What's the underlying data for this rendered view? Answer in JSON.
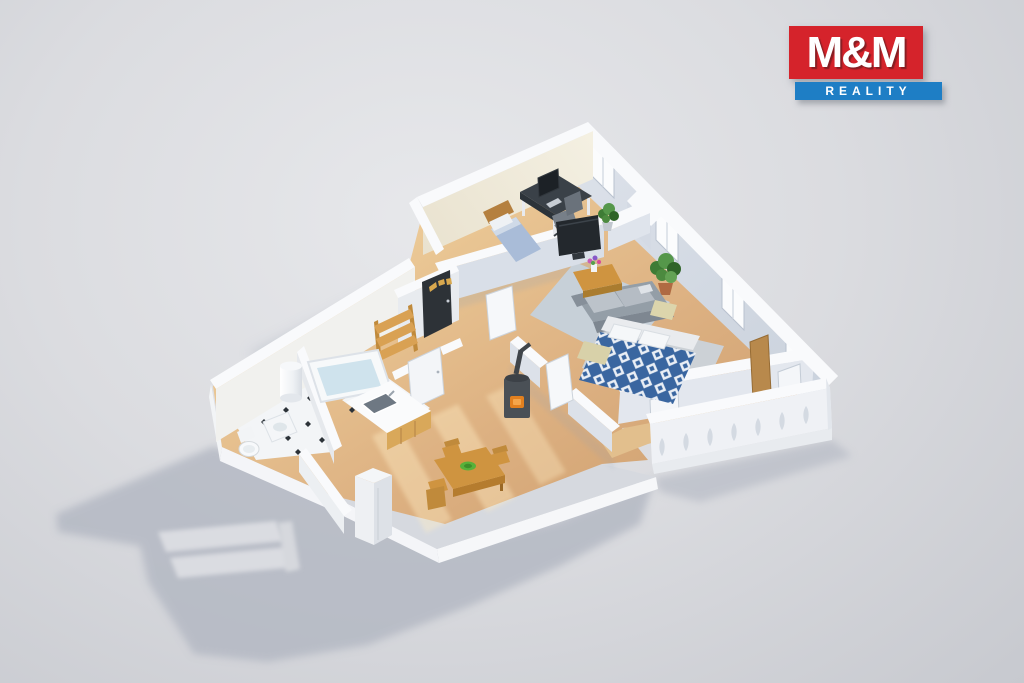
{
  "logo": {
    "title": "M&M",
    "subtitle": "REALITY"
  },
  "palette": {
    "bg_light": "#e7e8eb",
    "bg_mid": "#dbdce0",
    "bg_dark": "#c7c9cf",
    "shadow": "#b2b7c2",
    "wall_top": "#f9fafc",
    "wall_lit": "#f1eee2",
    "wall_shade": "#d5dbe5",
    "wood": "#ddb584",
    "wood_dark": "#c89a68",
    "tile": "#f3f5f7",
    "rug_living": "#c7d0d8",
    "rug_bed": "#ccd1d6",
    "bed_blue": "#3a66a0",
    "sofa_gray": "#949ea7",
    "furniture_wood": "#cf9440",
    "plant_green": "#4c8a3f",
    "door_dark": "#2d3237",
    "stove_dark": "#4a5056",
    "fire_orange": "#e2801f",
    "logo_red": "#d5232b",
    "logo_blue": "#1e7ec5",
    "logo_text": "#ffffff"
  },
  "scene": {
    "description": "3D isometric floor plan render of an apartment",
    "rooms": [
      "office",
      "living-room",
      "bedroom",
      "balcony",
      "hallway",
      "kitchen",
      "bathroom",
      "dining-area"
    ]
  }
}
